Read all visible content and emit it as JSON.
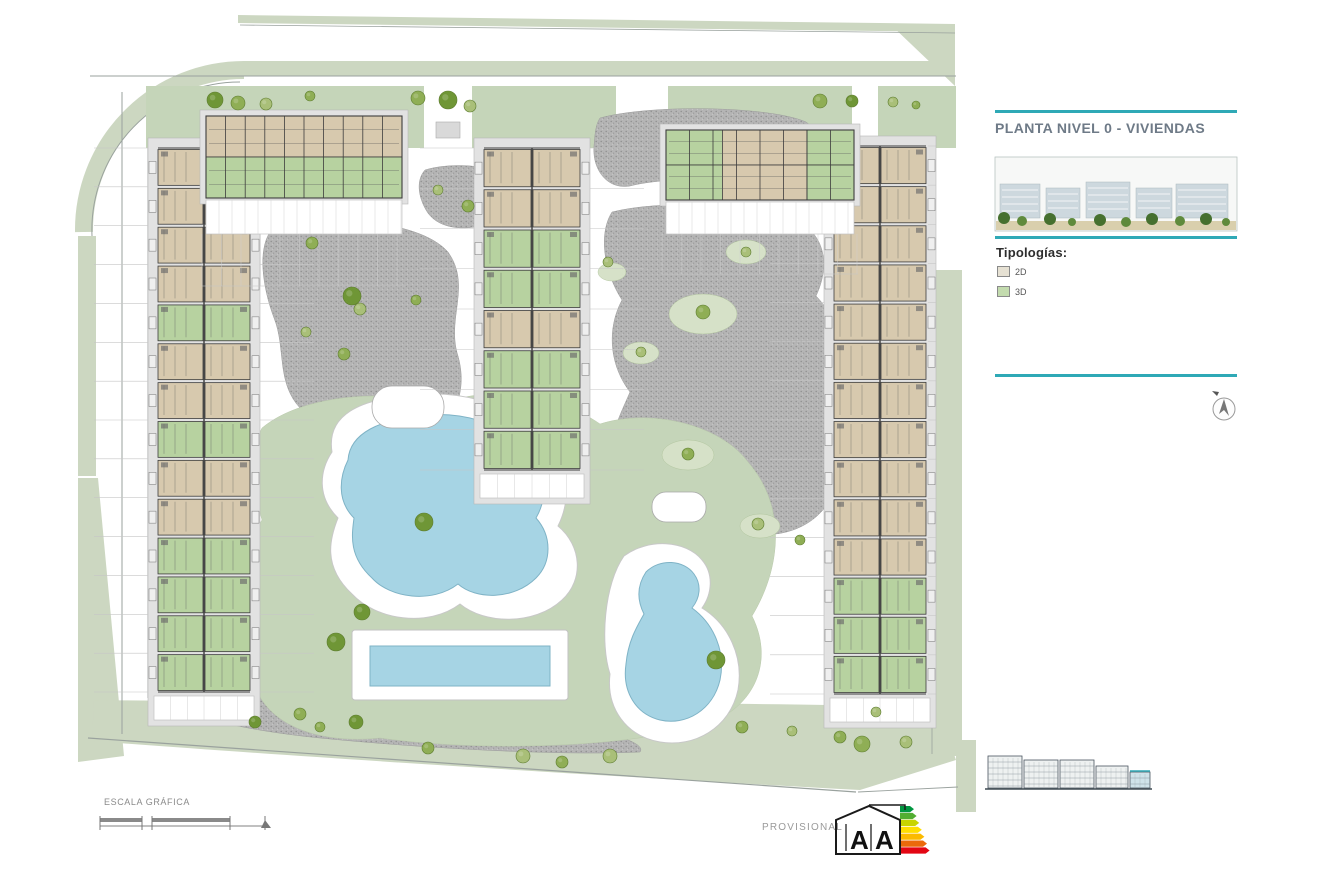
{
  "sheet": {
    "width": 1320,
    "height": 895,
    "bg": "#ffffff"
  },
  "panel": {
    "title": "PLANTA NIVEL 0 - VIVIENDAS",
    "title_color": "#6e7a87",
    "rule_color": "#2fa9b6",
    "legend_title": "Tipologías:",
    "legend_items": [
      {
        "label": "2D",
        "color": "#e6e1d3"
      },
      {
        "label": "3D",
        "color": "#c3dbae"
      }
    ]
  },
  "footer": {
    "scale_label": "ESCALA GRÁFICA",
    "provisional_label": "PROVISIONAL",
    "energy": {
      "letters": [
        "A",
        "A"
      ],
      "arrow_colors": [
        "#009640",
        "#52ae32",
        "#c8d400",
        "#ffde00",
        "#fbba00",
        "#eb690b",
        "#e30613"
      ]
    }
  },
  "site": {
    "colors": {
      "sage": "#ccd7c1",
      "lawn": "#c5d5b9",
      "lawn_light": "#d6e1c8",
      "water": "#a6d4e4",
      "water_stroke": "#7fb3c6",
      "beige": "#d7c9ae",
      "green_unit": "#b7d2a0",
      "wall": "#3d3d3d",
      "terrace": "#e2e2e2",
      "line": "#c6c6c6",
      "road": "#9aa29e",
      "tree_tones": [
        "#6f9636",
        "#8fae55",
        "#a9bf78"
      ],
      "teal": "#2fa9b6"
    },
    "sage_shapes": [
      {
        "d": "M238,15 L955,24 L955,32 L238,23 Z",
        "type": "fill"
      },
      {
        "d": "M84,232 A160,160 0 0 1 244,70",
        "type": "stroke",
        "w": 18
      },
      {
        "d": "M244,61 L955,61 L955,76 L244,76 Z",
        "type": "fill"
      },
      {
        "d": "M78,236 L96,236 L96,476 L78,476 Z",
        "type": "fill"
      },
      {
        "d": "M78,478 L98,478 L124,756 L78,762 Z",
        "type": "fill"
      },
      {
        "d": "M936,270 L962,270 L962,756 L936,756 Z",
        "type": "fill"
      },
      {
        "d": "M956,740 L976,740 L976,812 L956,812 Z",
        "type": "fill"
      },
      {
        "d": "M890,24 L955,24 L955,86 Z",
        "type": "fill"
      },
      {
        "d": "M94,700 C300,703 700,701 938,707 L956,760 L860,790 C600,776 300,757 92,741 Z",
        "type": "fill"
      }
    ],
    "road_lines": [
      {
        "d": "M240,25 L955,33",
        "w": 0.8
      },
      {
        "d": "M90,76 L956,76",
        "w": 1
      },
      {
        "d": "M122,92 L122,734",
        "w": 1
      },
      {
        "d": "M148,92 L148,698",
        "w": 1
      },
      {
        "d": "M92,236 A148,148 0 0 1 240,82",
        "w": 1
      },
      {
        "d": "M88,738 L856,792",
        "w": 1.2
      },
      {
        "d": "M858,792 L958,787",
        "w": 0.9
      },
      {
        "d": "M932,90 L932,754",
        "w": 0.8
      }
    ],
    "green_strip": {
      "rect": [
        146,
        86,
        810,
        62
      ]
    },
    "strip_gaps": [
      [
        424,
        84,
        48,
        66
      ],
      [
        616,
        84,
        52,
        66
      ],
      [
        852,
        84,
        26,
        66
      ]
    ],
    "strip_pads": [
      [
        436,
        122,
        24,
        16
      ],
      [
        629,
        122,
        24,
        16
      ]
    ],
    "gravel_blobs": [
      "M270,232 C320,214 418,218 448,252 C472,286 446,318 458,356 C470,398 448,438 408,442 C368,452 318,440 300,408 C276,382 286,348 274,318 C262,286 258,250 270,232 Z",
      "M425,170 C450,162 500,164 512,182 C522,200 508,218 488,224 C462,232 436,228 426,210 C418,196 416,180 425,170 Z",
      "M600,118 C650,104 770,106 806,122 C826,136 820,160 796,168 C746,180 668,176 630,186 C606,190 592,168 594,146 C595,132 596,124 600,118 Z",
      "M612,212 C660,200 740,204 786,216 C824,228 832,262 816,296 C842,322 848,370 828,412 C852,446 844,502 806,524 C772,544 726,534 700,508 C668,530 632,520 618,488 C600,452 618,420 630,392 C610,366 606,330 622,300 C604,272 598,234 612,212 Z",
      "M548,560 C572,548 600,556 608,580 C616,606 606,640 612,668 C618,700 600,722 576,718 C552,714 540,688 546,660 C534,628 534,584 548,560 Z",
      "M158,692 C260,688 420,700 520,716 C600,728 648,742 640,752 C560,756 420,748 320,738 C240,730 170,714 158,692 Z"
    ],
    "lawn_main": "M262,428 C300,396 380,388 440,404 C492,384 560,396 600,424 C650,408 720,424 748,462 C788,508 780,570 752,616 C776,664 752,712 700,726 C620,748 480,752 380,738 C300,746 248,712 252,660 C228,612 238,556 262,520 C252,484 248,454 262,428 Z",
    "lawn_pockets": [
      [
        703,
        314,
        34,
        20
      ],
      [
        746,
        252,
        20,
        12
      ],
      [
        688,
        455,
        26,
        15
      ],
      [
        641,
        353,
        18,
        11
      ],
      [
        760,
        526,
        20,
        12
      ],
      [
        612,
        272,
        14,
        9
      ]
    ],
    "pond_left_sand": "M332,452 C326,414 362,400 404,396 C458,388 512,404 538,432 C566,456 574,494 558,526 C582,546 584,580 562,600 C534,626 484,624 460,604 C428,628 376,620 352,594 C322,566 330,538 338,518 C316,496 320,470 332,452 Z",
    "pond_left_water": "M348,460 C350,432 382,420 418,416 C462,410 502,424 522,446 C544,466 550,494 536,518 C552,536 552,562 536,578 C514,600 476,600 458,584 C432,604 390,598 372,578 C348,556 352,534 354,518 C336,500 340,476 348,460 Z",
    "pond_right_sand": "M624,556 C648,538 686,540 702,560 C714,574 712,594 702,608 C728,624 744,656 738,690 C730,728 694,748 660,742 C626,736 606,708 610,674 C600,644 604,584 624,556 Z",
    "pond_right_water": "M646,572 C660,558 684,560 694,574 C702,585 700,598 692,608 C714,624 726,652 720,680 C713,710 686,726 660,720 C636,714 622,692 626,664 C628,642 636,628 644,614 C636,598 638,584 646,572 Z",
    "pool": {
      "deck": [
        352,
        630,
        216,
        70
      ],
      "water": [
        370,
        646,
        180,
        40
      ]
    },
    "huts": [
      [
        372,
        386,
        72,
        42,
        20
      ],
      [
        652,
        492,
        54,
        30,
        14
      ]
    ],
    "vbuildings": [
      {
        "id": "left",
        "x": 156,
        "y": 148,
        "w": 96,
        "h": 544,
        "rows": 14,
        "pattern": "bbbbgbbgbbgggg"
      },
      {
        "id": "middle",
        "x": 482,
        "y": 148,
        "w": 100,
        "h": 322,
        "rows": 8,
        "pattern": "bbggbggg"
      },
      {
        "id": "right",
        "x": 832,
        "y": 146,
        "w": 96,
        "h": 548,
        "rows": 14,
        "pattern": "bbbbbbbbbbbggg"
      }
    ],
    "hbuildings": [
      {
        "id": "top-left",
        "x": 206,
        "y": 116,
        "w": 196,
        "h": 82,
        "cols": 10,
        "bands": [
          [
            [
              "b",
              1
            ]
          ],
          [
            [
              "g",
              1
            ]
          ]
        ],
        "terraceH": 34,
        "plotH": 52
      },
      {
        "id": "top-right",
        "x": 666,
        "y": 130,
        "w": 188,
        "h": 70,
        "cols": 8,
        "bands": [
          [
            [
              "g",
              0.3
            ],
            [
              "b",
              0.45
            ],
            [
              "g",
              0.25
            ]
          ],
          [
            [
              "g",
              0.3
            ],
            [
              "b",
              0.45
            ],
            [
              "g",
              0.25
            ]
          ]
        ],
        "terraceH": 32,
        "plotH": 40
      }
    ],
    "trees": [
      [
        215,
        100,
        8,
        0
      ],
      [
        238,
        103,
        7,
        1
      ],
      [
        266,
        104,
        6,
        2
      ],
      [
        310,
        96,
        5,
        1
      ],
      [
        418,
        98,
        7,
        1
      ],
      [
        448,
        100,
        9,
        0
      ],
      [
        470,
        106,
        6,
        2
      ],
      [
        820,
        101,
        7,
        1
      ],
      [
        852,
        101,
        6,
        0
      ],
      [
        893,
        102,
        5,
        2
      ],
      [
        916,
        105,
        4,
        1
      ],
      [
        312,
        243,
        6,
        1
      ],
      [
        352,
        296,
        9,
        0
      ],
      [
        360,
        309,
        6,
        2
      ],
      [
        416,
        300,
        5,
        1
      ],
      [
        306,
        332,
        5,
        2
      ],
      [
        344,
        354,
        6,
        1
      ],
      [
        438,
        190,
        5,
        2
      ],
      [
        468,
        206,
        6,
        1
      ],
      [
        703,
        312,
        7,
        1
      ],
      [
        746,
        252,
        5,
        2
      ],
      [
        688,
        454,
        6,
        1
      ],
      [
        641,
        352,
        5,
        2
      ],
      [
        424,
        522,
        9,
        0
      ],
      [
        716,
        660,
        9,
        0
      ],
      [
        362,
        612,
        8,
        0
      ],
      [
        336,
        642,
        9,
        0
      ],
      [
        300,
        714,
        6,
        1
      ],
      [
        356,
        722,
        7,
        0
      ],
      [
        428,
        748,
        6,
        1
      ],
      [
        523,
        756,
        7,
        2
      ],
      [
        562,
        762,
        6,
        1
      ],
      [
        610,
        756,
        7,
        2
      ],
      [
        742,
        727,
        6,
        1
      ],
      [
        792,
        731,
        5,
        2
      ],
      [
        840,
        737,
        6,
        1
      ],
      [
        876,
        712,
        5,
        2
      ],
      [
        862,
        744,
        8,
        1
      ],
      [
        906,
        742,
        6,
        2
      ],
      [
        255,
        722,
        6,
        0
      ],
      [
        320,
        727,
        5,
        1
      ],
      [
        758,
        524,
        6,
        2
      ],
      [
        800,
        540,
        5,
        1
      ],
      [
        608,
        262,
        5,
        2
      ]
    ],
    "elevation_blocks": [
      [
        988,
        756,
        34,
        32,
        "#eef1f1"
      ],
      [
        1024,
        760,
        34,
        28,
        "#eef1f1"
      ],
      [
        1060,
        760,
        34,
        28,
        "#eef1f1"
      ],
      [
        1096,
        766,
        32,
        22,
        "#eef1f1"
      ],
      [
        1130,
        772,
        20,
        16,
        "#cfe3ea"
      ]
    ]
  }
}
